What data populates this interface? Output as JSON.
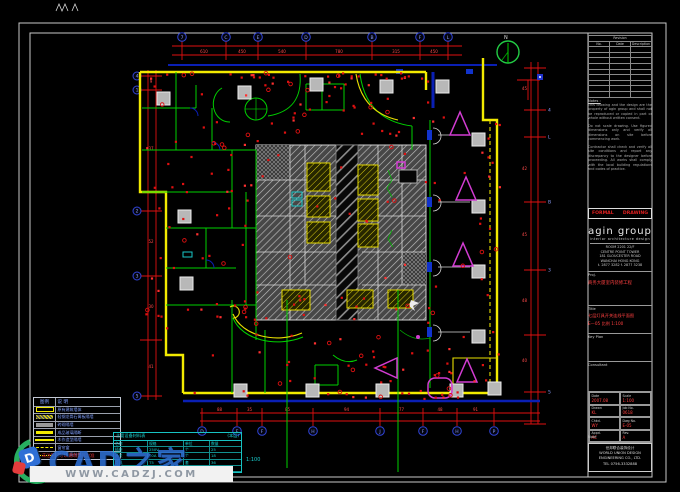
{
  "watermark": {
    "brand": "CAD之家",
    "site": "WWW.CADZJ.COM",
    "logo_letter": "D"
  },
  "plan": {
    "north_label": "N",
    "scale_note": "1:100",
    "grid": {
      "top_letters": [
        "7",
        "C",
        "E",
        "D",
        "B",
        "F",
        "L"
      ],
      "top_xs": [
        182,
        226,
        258,
        306,
        372,
        420,
        448
      ],
      "top_dims": [
        "610",
        "450",
        "540",
        "780",
        "315",
        "450"
      ],
      "bottom_letters": [
        "D",
        "E",
        "F",
        "H",
        "J",
        "F",
        "H",
        "P"
      ],
      "bottom_xs": [
        202,
        237,
        262,
        313,
        380,
        423,
        457,
        494
      ],
      "bottom_dims": [
        "88",
        "35",
        "85",
        "94",
        "77",
        "48",
        "91"
      ],
      "left_letters": [
        "4",
        "1",
        "2",
        "3",
        "5"
      ],
      "left_ys": [
        76,
        90,
        211,
        276,
        396
      ],
      "left_dims": [
        "9",
        "37",
        "52",
        "30",
        "41"
      ],
      "right_letters": [
        "4",
        "L",
        "B",
        "3",
        "5"
      ],
      "right_ys": [
        110,
        137,
        202,
        270,
        392
      ],
      "right_dims": [
        "45",
        "42",
        "45",
        "48",
        "40"
      ]
    }
  },
  "legend": {
    "headers": [
      "图例",
      "说 明"
    ],
    "rows": [
      {
        "symbol": "hollow-bar",
        "desc": "原有建筑墙体"
      },
      {
        "symbol": "hatch-bar",
        "desc": "轻钢龙骨石膏板隔墙"
      },
      {
        "symbol": "gray-bar",
        "desc": "砖砌隔墙"
      },
      {
        "symbol": "solid-bar",
        "desc": "成品玻璃隔断"
      },
      {
        "symbol": "tick-line",
        "desc": "木作造型隔墙"
      },
      {
        "symbol": "dash-line",
        "desc": "窗帘盒"
      },
      {
        "symbol": "dot-line",
        "desc": "地坪标高分界"
      }
    ],
    "note": "注:未注明尺寸以现场实际为准"
  },
  "schedule": {
    "title": "主要设备材料表",
    "title_right": "(本层)",
    "headers": [
      "名称",
      "规格",
      "单位",
      "数量"
    ],
    "rows": [
      [
        "插座",
        "250V",
        "个",
        "25"
      ],
      [
        "开关",
        "10A",
        "个",
        "18"
      ],
      [
        "灯具",
        "T5",
        "套",
        "36"
      ],
      [
        "配电箱",
        "AL",
        "台",
        "2"
      ]
    ]
  },
  "titleblock": {
    "revision": {
      "title": "Revision",
      "headers": [
        "No.",
        "Date",
        "Description"
      ],
      "empty_rows": 9
    },
    "notes_label": "Notes :",
    "notes": [
      "This drawing and the design are the property of agin group and shall not be reproduced or copied in part or whole without written consent.",
      "Do not scale drawing. Use figured dimensions only and verify all dimensions on site before commencing work.",
      "Contractor shall check and verify all site conditions and report any discrepancy to the designer before proceeding. All works shall comply with the local building regulations and codes of practice."
    ],
    "stamp_left": "FORMAL",
    "stamp_right": "DRAWING",
    "logo": "agin group",
    "logo_sub": "interior architecture design",
    "address": [
      "ROOM 2201 22/F",
      "CENTRE POINT TOWER",
      "181 GLOUCESTER ROAD",
      "WANCHAI HONG KONG"
    ],
    "contact": "t. 2877 3282  f. 2877 3238",
    "project_label": "Proj.",
    "project_name": "商务大厦室内装修工程",
    "title_label": "Title",
    "title_lines": [
      "七层灯具开关连线平面图",
      "E—05  比例 1:100"
    ],
    "keyplan_label": "Key Plan",
    "consultant_label": "Consultant",
    "fields": [
      {
        "label": "Date",
        "value": "2007.08"
      },
      {
        "label": "Scale",
        "value": "1:100"
      },
      {
        "label": "Drawn",
        "value": "KL"
      },
      {
        "label": "Job No.",
        "value": "0618"
      },
      {
        "label": "Chkd.",
        "value": "WY"
      },
      {
        "label": "Dwg No.",
        "value": "E-05"
      },
      {
        "label": "Appd.",
        "value": "AC"
      },
      {
        "label": "Rev.",
        "value": "A"
      }
    ],
    "note_label": "Note",
    "company": [
      "世邦联合装饰设计",
      "WORLD UNION DESIGN",
      "ENGINEERING CO., LTD.",
      "TEL 0756-3332888"
    ]
  }
}
